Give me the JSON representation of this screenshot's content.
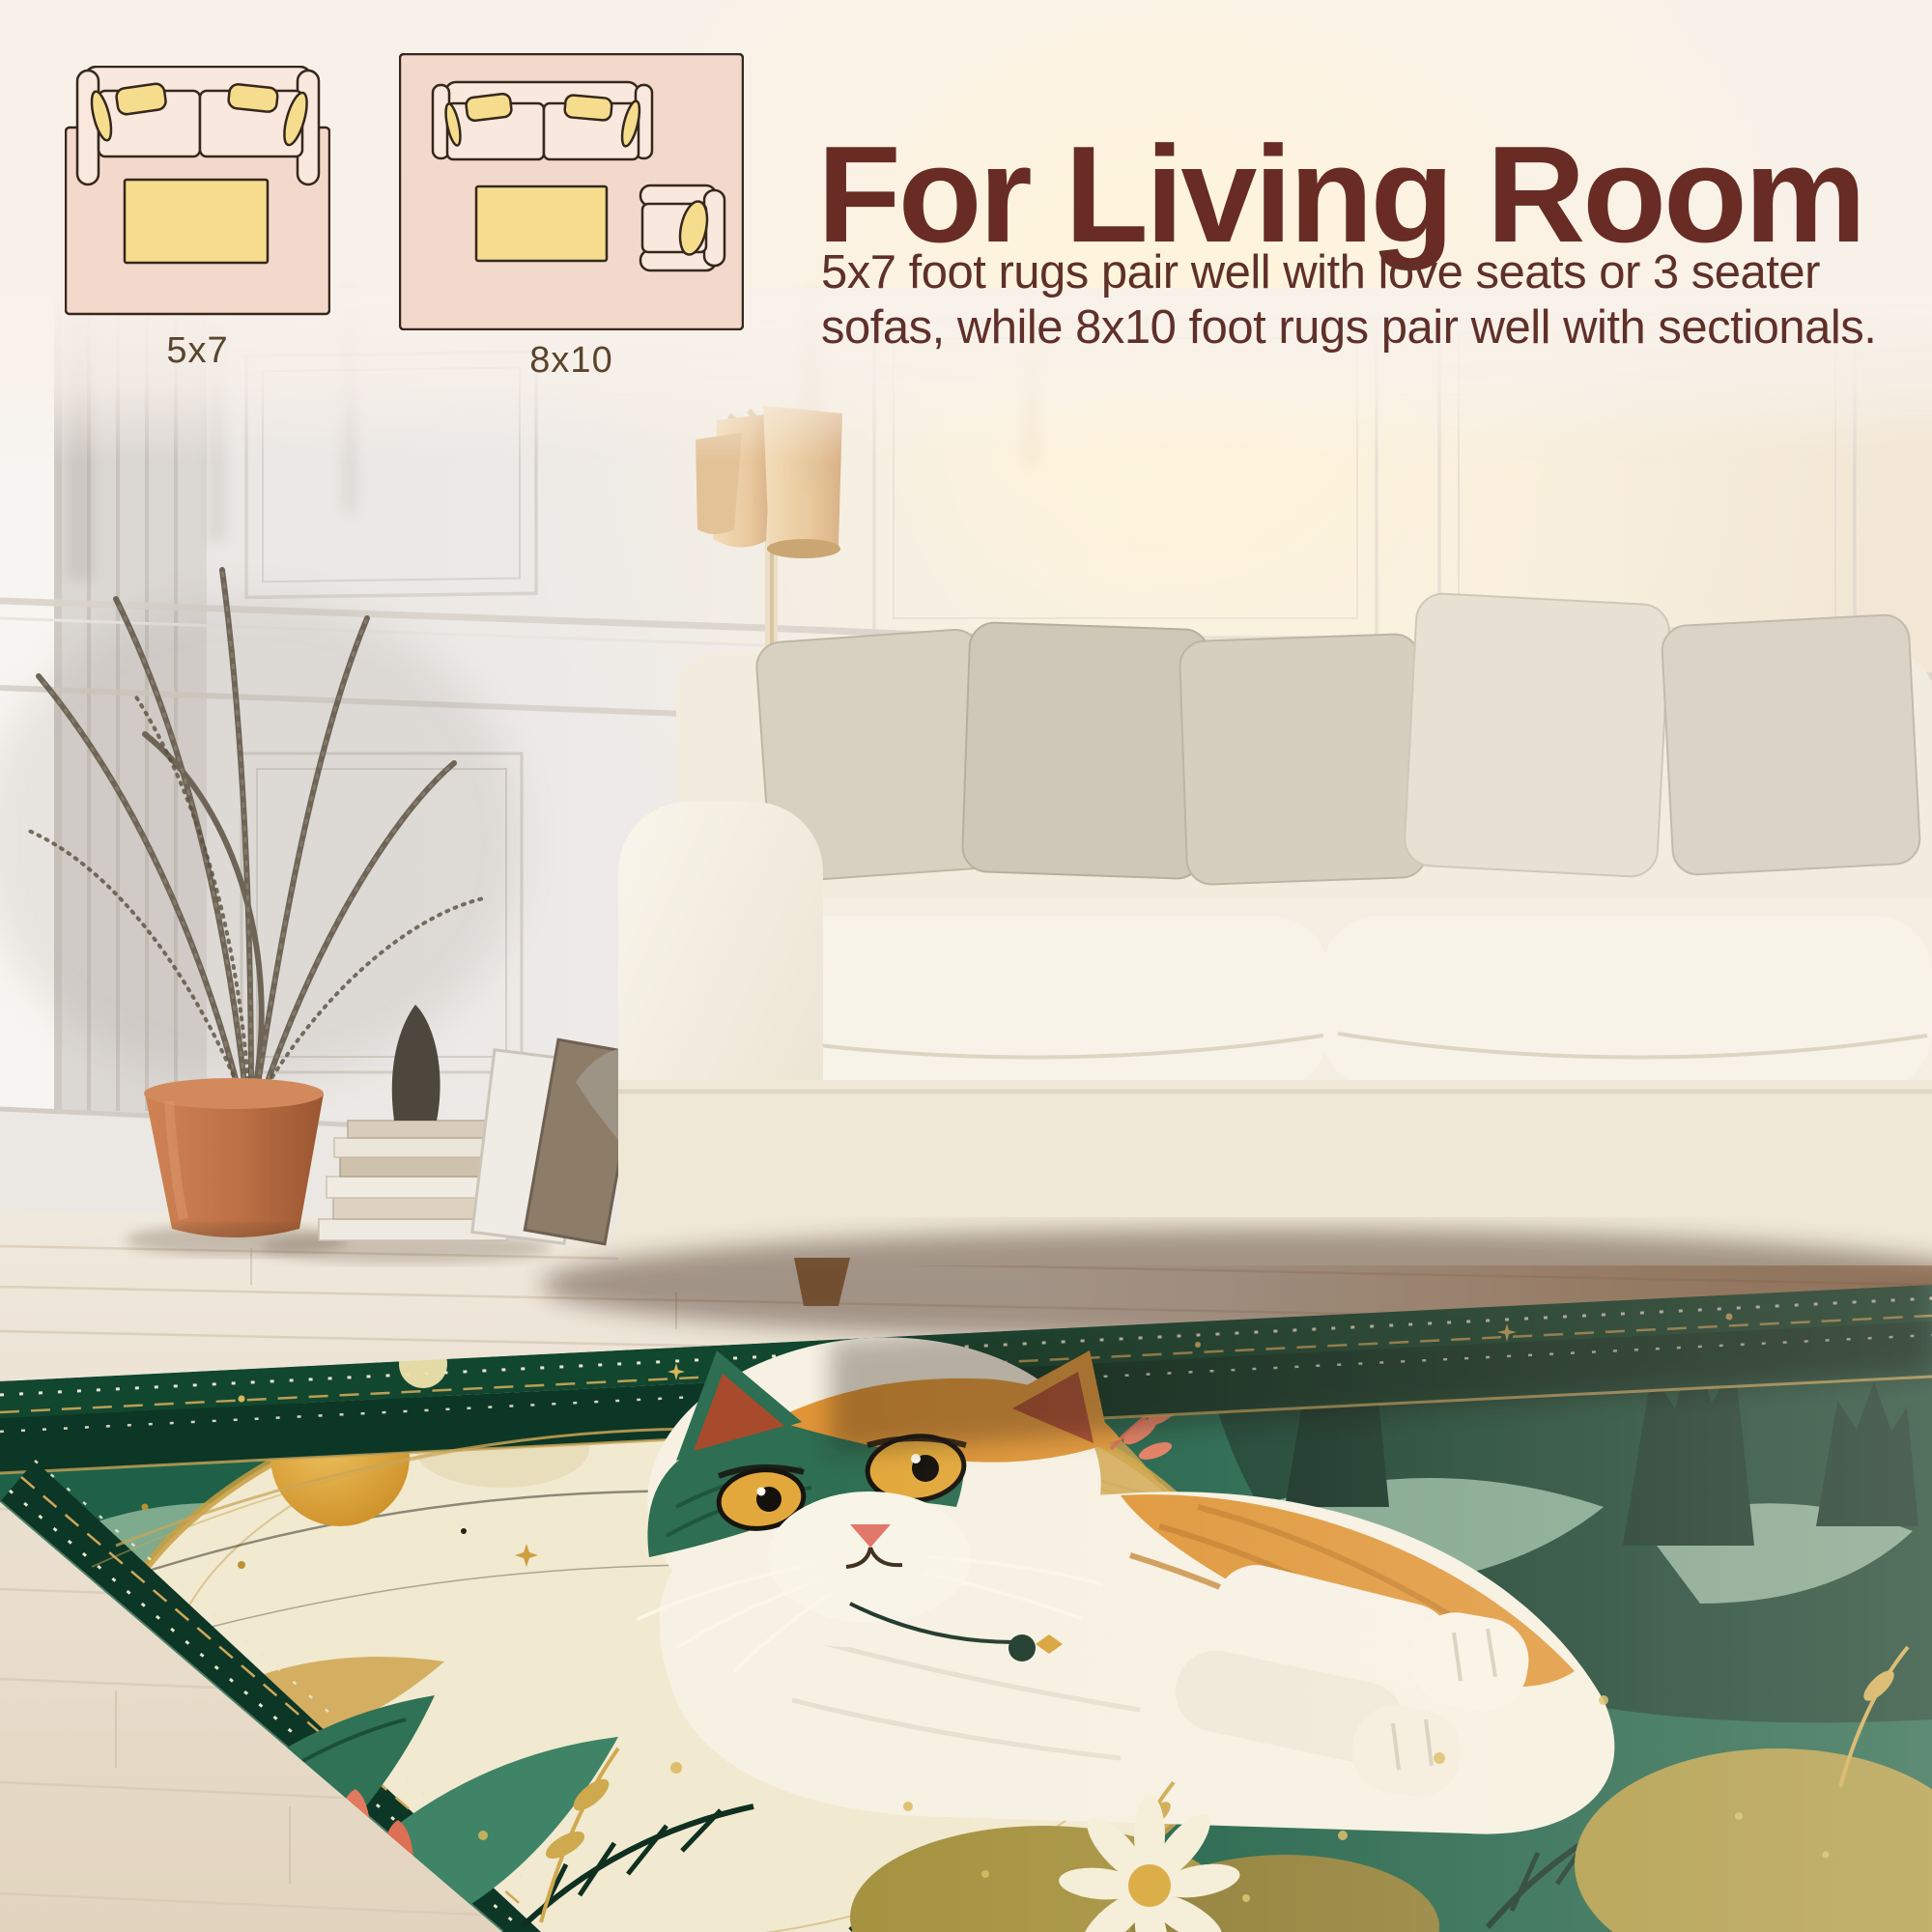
{
  "page": {
    "background_color": "#f8f1ea"
  },
  "header": {
    "title": "For Living Room",
    "title_color": "#682c24",
    "description": "5x7 foot rugs pair well with love seats or 3 seater sofas, while 8x10 foot rugs pair well with sectionals.",
    "description_color": "#5f302a"
  },
  "size_guide": {
    "label_color": "#5a452c",
    "diagrams": [
      {
        "label": "5x7",
        "furniture": [
          "loveseat-sofa-top-view",
          "coffee-table"
        ],
        "rug_color": "#f3d9cb",
        "cushion_color": "#f8e8dd",
        "accent_color": "#f5dd8d"
      },
      {
        "label": "8x10",
        "furniture": [
          "three-seater-sofa-top-view",
          "coffee-table",
          "armchair-top-view"
        ],
        "rug_color": "#f3d9cb",
        "cushion_color": "#f8e8dd",
        "accent_color": "#f5dd8d"
      }
    ]
  },
  "scene": {
    "type": "living-room-photograph",
    "elements": [
      "paneled-wall",
      "door-frame",
      "floor-lamp-three-shades",
      "dried-palm-plant",
      "terracotta-pot",
      "stacked-books",
      "statuette",
      "leaning-frames",
      "fluted-vase",
      "white-sofa",
      "throw-pillows",
      "whitewashed-wood-floor",
      "area-rug"
    ],
    "rug_art": [
      "full-moon",
      "gold-sun",
      "calico-cat",
      "small-moon",
      "stars",
      "pine-forest",
      "mint-hills",
      "daisy-flower",
      "tulip-flowers",
      "gold-foliage",
      "dotted-border"
    ],
    "rug_colors": {
      "border": "#0c3625",
      "field": "#1e6148",
      "sky": "#0f3d2a",
      "moon": "#f1ead0",
      "gold": "#cfa75a",
      "cat_white": "#f6f1e3",
      "cat_orange": "#df9537",
      "ear_red": "#a84a2c",
      "eye_amber": "#e2a83c",
      "mint": "#9ec4ab",
      "coral": "#e17a5e",
      "olive": "#a5923f"
    }
  }
}
